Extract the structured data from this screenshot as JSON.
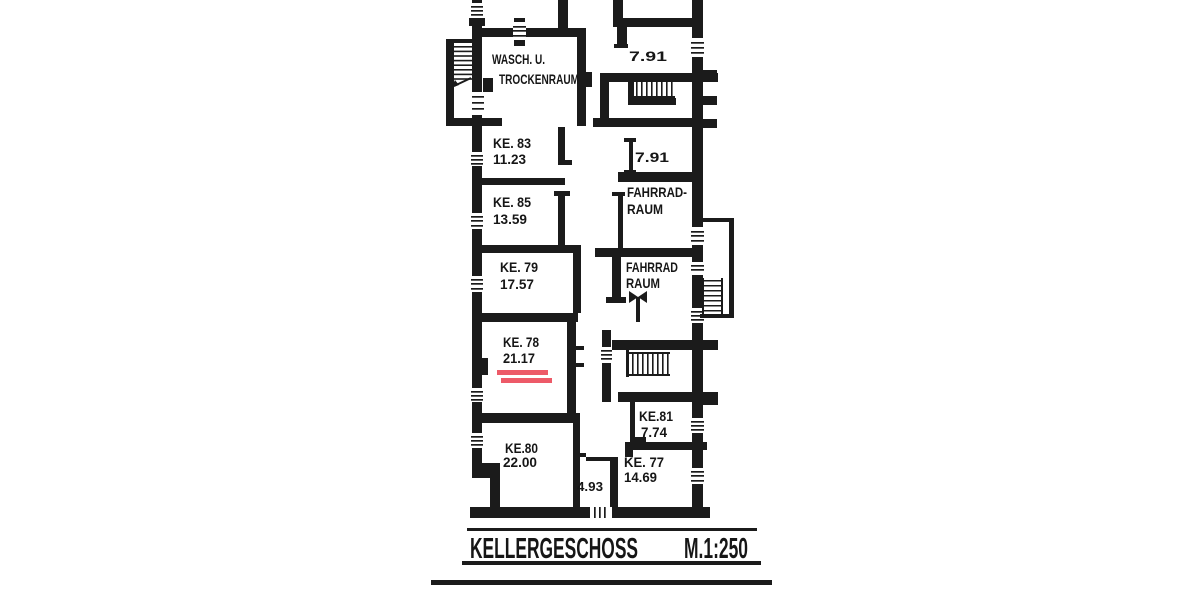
{
  "plan": {
    "title": {
      "name": "KELLERGESCHOSS",
      "scale": "M.1:250"
    },
    "rooms": {
      "wasch": {
        "line1": "WASCH. U.",
        "line2": "TROCKENRAUM"
      },
      "ke83": {
        "name": "KE. 83",
        "area": "11.23"
      },
      "ke85": {
        "name": "KE. 85",
        "area": "13.59"
      },
      "ke79": {
        "name": "KE. 79",
        "area": "17.57"
      },
      "ke78": {
        "name": "KE. 78",
        "area": "21.17"
      },
      "ke80": {
        "name": "KE.80",
        "area": "22.00"
      },
      "ke81": {
        "name": "KE.81",
        "area": "7.74"
      },
      "ke77": {
        "name": "KE.  77",
        "area": "14.69"
      },
      "r791_top": {
        "area": "7.91"
      },
      "r791_mid": {
        "area": "7.91"
      },
      "fahrrad_upper": {
        "line1": "FAHRRAD-",
        "line2": "RAUM"
      },
      "fahrrad_lower": {
        "line1": "FAHRRAD",
        "line2": "RAUM"
      },
      "corridor": {
        "area": "4.93"
      }
    },
    "highlight": {
      "room": "KE. 78",
      "color": "#ed5a68"
    }
  }
}
